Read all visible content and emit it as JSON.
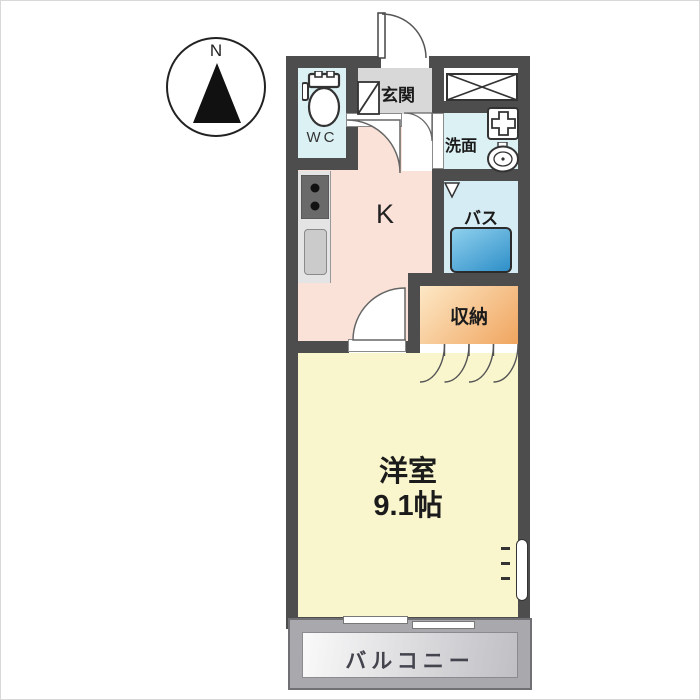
{
  "compass": {
    "label": "N"
  },
  "rooms": {
    "wc": {
      "label": "WC"
    },
    "genkan": {
      "label": "玄関"
    },
    "washroom": {
      "label": "洗面"
    },
    "kitchen": {
      "label": "K"
    },
    "bath": {
      "label": "バス"
    },
    "storage": {
      "label": "収納"
    },
    "western_room": {
      "label": "洋室",
      "size": "9.1帖"
    },
    "balcony": {
      "label": "バルコニー"
    }
  },
  "icons": [
    "compass-north-icon",
    "toilet-icon",
    "entrance-door-icon",
    "shoe-closet-x-icon",
    "washing-machine-pan-icon",
    "basin-icon",
    "stove-icon",
    "kitchen-sink-icon",
    "bathtub-icon",
    "folding-door-icon",
    "door-swing-icon",
    "sliding-window-icon",
    "side-window-icon"
  ],
  "colors": {
    "wall": "#4d4d4d",
    "wc_bg": "#dcf1f4",
    "washroom_bg": "#dcf1f4",
    "bath_bg": "#d6ecf4",
    "kitchen_bg": "#fae2d9",
    "genkan_bg": "#d8d8d8",
    "room_bg": "#f9f5cd",
    "storage_start": "#fde8c6",
    "storage_end": "#f0a55f",
    "tub_start": "#8fd0ee",
    "tub_end": "#2e8fc8",
    "balcony_wall": "#a8a8ad",
    "balcony_floor_start": "#fafafa",
    "balcony_floor_end": "#bfbfc4"
  }
}
